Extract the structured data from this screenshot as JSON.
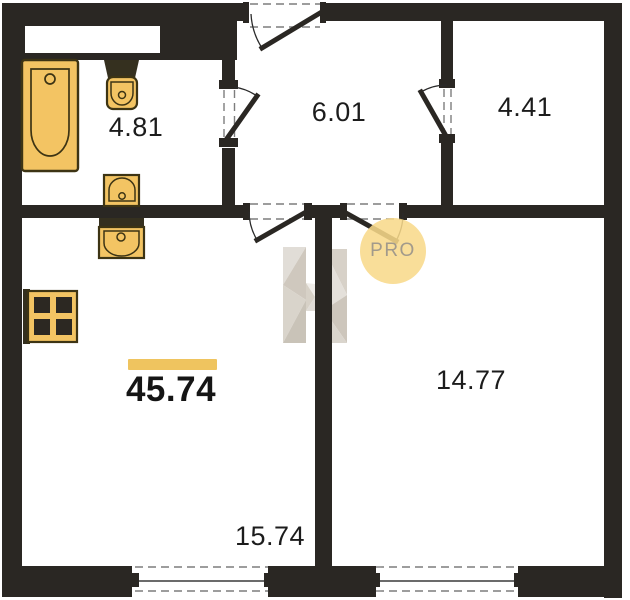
{
  "floorplan": {
    "total_area": "45.74",
    "rooms": {
      "bathroom": "4.81",
      "hallway": "6.01",
      "small_room": "4.41",
      "kitchen_living": "15.74",
      "room": "14.77"
    },
    "watermark": {
      "badge_text": "PRO",
      "letter": "H"
    },
    "colors": {
      "wall": "#2a2723",
      "fixture_fill": "#f3c463",
      "fixture_stroke": "#3d3414",
      "fixture_dark": "#35301f",
      "highlight_bar": "#efc45f",
      "watermark_circle": "#f8d98a",
      "watermark_text": "#a29a8b",
      "dashed_line": "#7d7d7d"
    }
  }
}
